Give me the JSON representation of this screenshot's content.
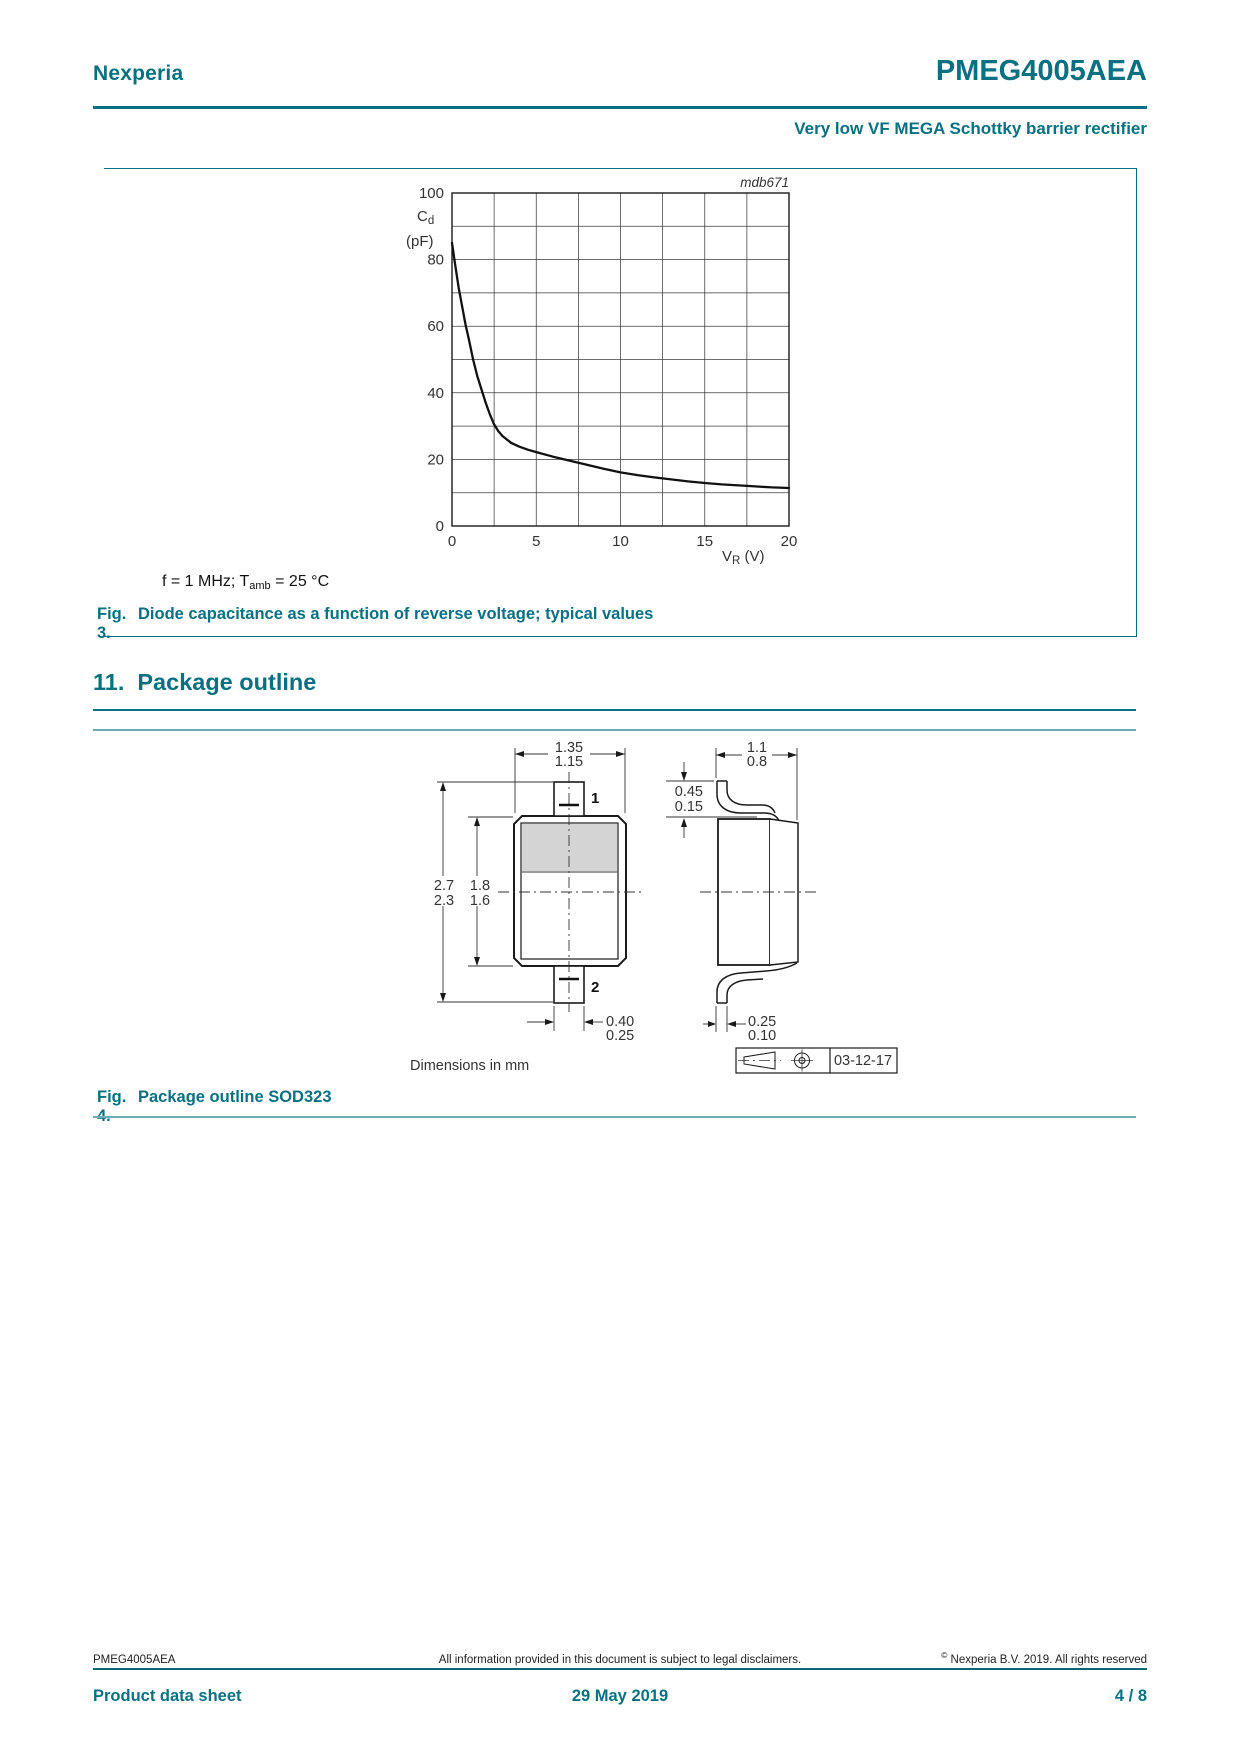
{
  "header": {
    "brand": "Nexperia",
    "part": "PMEG4005AEA",
    "subtitle": "Very low VF MEGA Schottky barrier rectifier"
  },
  "colors": {
    "teal": "#077181",
    "teal_light": "#69aeb6"
  },
  "chart_data": {
    "type": "line",
    "title": "Diode capacitance as a function of reverse voltage; typical values",
    "plot_label": "mdb671",
    "xlabel": "VR (V)",
    "ylabel": "Cd (pF)",
    "xlabel_main": "V",
    "xlabel_sub": "R",
    "xlabel_unit": " (V)",
    "ylabel_main": "C",
    "ylabel_sub": "d",
    "ylabel_unit": "(pF)",
    "xlim": [
      0,
      20
    ],
    "ylim": [
      0,
      100
    ],
    "x_ticks": [
      0,
      5,
      10,
      15,
      20
    ],
    "y_ticks": [
      0,
      20,
      40,
      60,
      80,
      100
    ],
    "x_grid_step": 2.5,
    "y_grid_step": 10,
    "grid": true,
    "legend": "none",
    "condition": "f = 1 MHz; Tamb = 25 °C",
    "x": [
      0,
      0.2,
      0.4,
      0.6,
      0.8,
      1,
      1.25,
      1.5,
      1.75,
      2,
      2.25,
      2.5,
      2.75,
      3,
      3.5,
      4,
      4.5,
      5,
      6,
      7,
      7.5,
      8,
      9,
      10,
      11,
      12,
      13,
      14,
      15,
      16,
      17,
      18,
      19,
      20
    ],
    "y": [
      85,
      78,
      71.5,
      66,
      60.5,
      56,
      50,
      45,
      41,
      37,
      33.5,
      30.5,
      28.5,
      27,
      25,
      23.8,
      22.9,
      22.2,
      20.8,
      19.6,
      19,
      18.4,
      17.2,
      16.1,
      15.3,
      14.6,
      14,
      13.4,
      12.9,
      12.5,
      12.2,
      11.9,
      11.6,
      11.4
    ]
  },
  "fig3": {
    "condition_pre": "f = 1 MHz; T",
    "condition_sub": "amb",
    "condition_post": " = 25 °C",
    "fig_label": "Fig. 3.",
    "caption": "Diode capacitance as a function of reverse voltage; typical values"
  },
  "section": {
    "number": "11.",
    "title": "Package outline"
  },
  "fig4": {
    "fig_label": "Fig. 4.",
    "caption": "Package outline SOD323",
    "dims_note": "Dimensions in mm",
    "date": "03-12-17",
    "pin1": "1",
    "pin2": "2",
    "dims": {
      "front_width_max": "1.35",
      "front_width_min": "1.15",
      "height_max": "2.7",
      "height_min": "2.3",
      "body_height_max": "1.8",
      "body_height_min": "1.6",
      "lead_width_max": "0.40",
      "lead_width_min": "0.25",
      "side_width_max": "1.1",
      "side_width_min": "0.8",
      "lead_clear_max": "0.45",
      "lead_clear_min": "0.15",
      "lead_thick_max": "0.25",
      "lead_thick_min": "0.10"
    }
  },
  "footer": {
    "part": "PMEG4005AEA",
    "disclaimer": "All information provided in this document is subject to legal disclaimers.",
    "copyright_sym": "©",
    "copyright": "Nexperia B.V. 2019. All rights reserved",
    "doc_type": "Product data sheet",
    "date": "29 May 2019",
    "page": "4 / 8"
  }
}
